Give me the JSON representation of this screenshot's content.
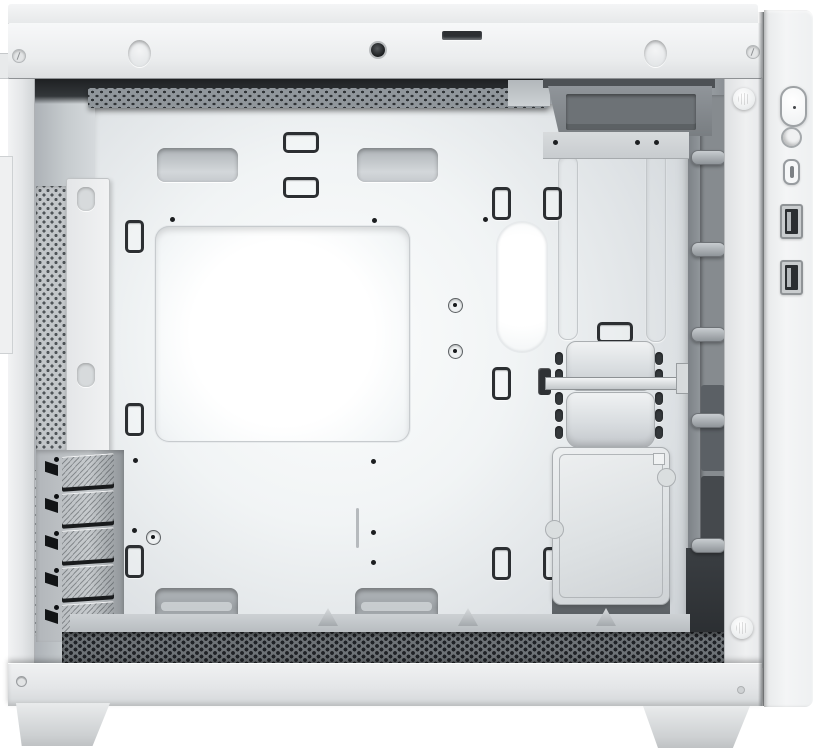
{
  "scene": {
    "description": "White mini-tower PC case photographed from the side with the side panel removed, showing an empty interior: motherboard tray with CPU cooler cutout and cable-routing holes, rear expansion slots, drive trays, front I/O on the right edge",
    "orientation": "side view, front panel on the right, rear on the left"
  },
  "colors": {
    "frame": "#eceeef",
    "frame_hi": "#f6f7f8",
    "frame_lo": "#dcdee0",
    "panel": "#f2f3f4",
    "interior_hi": "#cfd3d6",
    "interior_lo": "#9aa0a5",
    "tray_hi": "#fbfcfd",
    "tray_lo": "#d3d8db",
    "dark_detail": "#2b2e31",
    "mesh_floor": "#6f7478",
    "metal": "#b5babd",
    "foot": "#d4d7d9"
  },
  "front_io": {
    "items": [
      {
        "id": "power-button",
        "type": "power"
      },
      {
        "id": "reset-button",
        "type": "reset"
      },
      {
        "id": "usb-c-port",
        "type": "usb_c"
      },
      {
        "id": "usb-a-port-1",
        "type": "usb_a"
      },
      {
        "id": "usb-a-port-2",
        "type": "usb_a"
      }
    ]
  },
  "expansion": {
    "slot_count": 5
  },
  "drives": {
    "tray_count": 2,
    "ssd_plate_count": 1
  },
  "fasteners": {
    "thumbscrew_count": 2
  },
  "geometry": {
    "bar_ovals_x": [
      120,
      636
    ],
    "standoff_holes": [
      [
        170,
        217
      ],
      [
        372,
        218
      ],
      [
        483,
        217
      ],
      [
        133,
        458
      ],
      [
        371,
        459
      ],
      [
        132,
        528
      ],
      [
        371,
        530
      ],
      [
        371,
        560
      ]
    ],
    "ring_holes": [
      [
        448,
        298
      ],
      [
        448,
        344
      ],
      [
        146,
        530
      ]
    ],
    "clips_vertical": [
      [
        125,
        220
      ],
      [
        125,
        403
      ],
      [
        125,
        545
      ],
      [
        492,
        187
      ],
      [
        543,
        187
      ],
      [
        492,
        367
      ],
      [
        492,
        547
      ],
      [
        543,
        547
      ]
    ],
    "clips_horizontal": [
      [
        283,
        132
      ],
      [
        283,
        177
      ],
      [
        597,
        322
      ]
    ],
    "front_pegs_y": [
      150,
      242,
      327,
      413,
      538
    ],
    "tray_slot_columns_x": [
      555,
      655
    ],
    "tray_slot_rows_y": [
      352,
      369,
      392,
      409,
      426
    ],
    "floor_bumps_x": [
      318,
      458,
      596
    ],
    "top_cutouts": [
      [
        157,
        148
      ],
      [
        357,
        148
      ]
    ],
    "bottom_cutouts": [
      [
        155,
        588
      ],
      [
        355,
        588
      ]
    ],
    "grooves": [
      [
        558,
        155,
        183
      ],
      [
        646,
        150,
        190
      ]
    ],
    "drive_tray_y": [
      341,
      392
    ],
    "drive_tray_h": [
      48,
      54
    ],
    "pcie": {
      "x": 62,
      "y0": 455,
      "step": 37,
      "cover_w": 52,
      "cover_h": 30,
      "screw_x": 54,
      "notch_x": 45
    },
    "io_y": {
      "power": 86,
      "reset": 127,
      "usb_c": 159,
      "usb_a": [
        204,
        260
      ]
    },
    "thumbscrews": [
      [
        733,
        88
      ],
      [
        731,
        617
      ]
    ],
    "ssd_notches": [
      [
        657,
        468
      ],
      [
        545,
        520
      ]
    ]
  }
}
